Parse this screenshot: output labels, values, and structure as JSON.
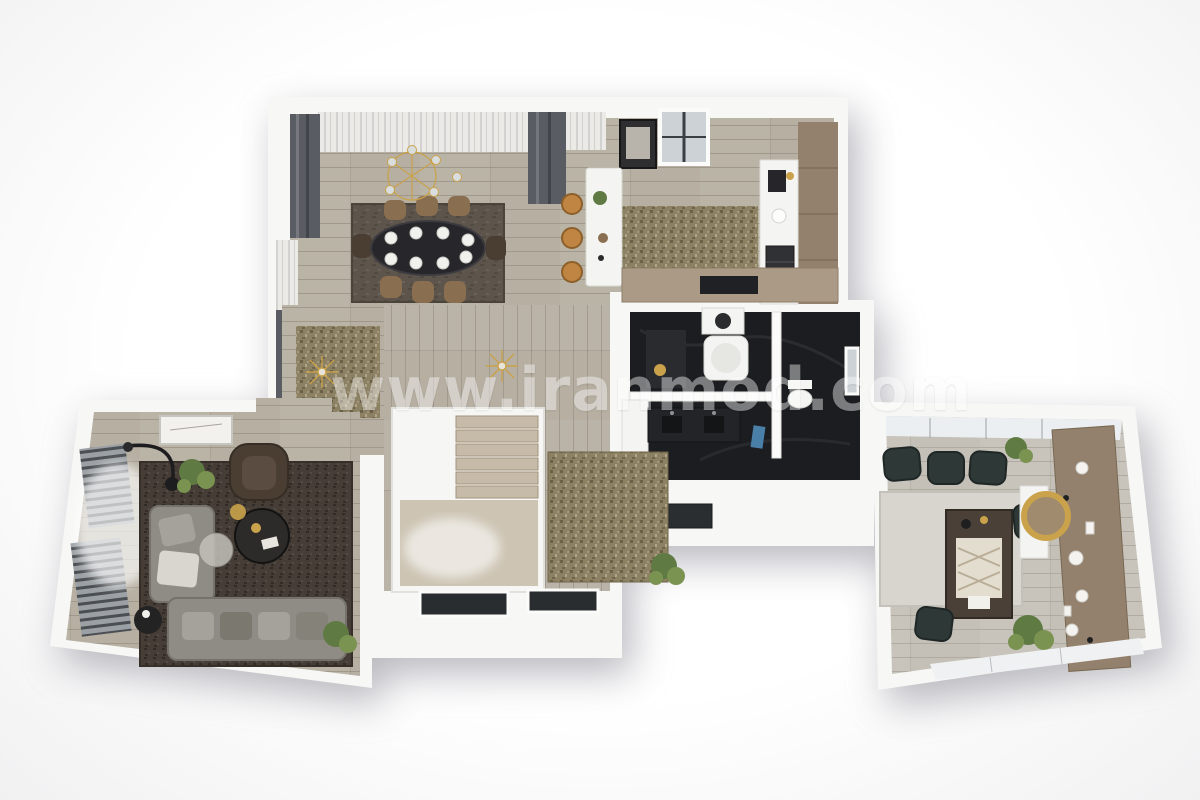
{
  "meta": {
    "description": "3D rendered top-down floor plan of an apartment, photoreal style, no text labels except watermark"
  },
  "watermark": {
    "text": "www.iranmod.com"
  },
  "palette": {
    "page_bg": "#fafafa",
    "wall_white": "#f7f7f5",
    "wall_shadow": "#dddcd8",
    "wood_floor": "#b6afa2",
    "wood_floor_right": "#c4c0b7",
    "stairs_wood": "#c6bba8",
    "landing_wood": "#cdc4b3",
    "marble_dark": "#1c1d20",
    "rug_dining": "#5d554b",
    "rug_gold": "#8d8164",
    "rug_dark": "#453d36",
    "rug_light": "#d8d5ce",
    "sofa_gray": "#8f8c85",
    "cushion_gray": "#a5a29b",
    "armchair_brown": "#4a3e33",
    "chair_tan": "#8a6e50",
    "stool_amber": "#c08543",
    "chair_teal": "#2e3937",
    "table_dark": "#27272b",
    "wood_cabinet": "#93816e",
    "peninsula_wood": "#ab9a86",
    "gold_accent": "#c9a24b",
    "plant_green": "#5f7a43",
    "plant_green_light": "#7a9350",
    "fixture_white": "#f4f4f2",
    "curtain_dark": "#595c62",
    "curtain_sheer": "#eceae7",
    "window_glass": "#ccd2d6",
    "towel_blue": "#4a7fa8",
    "watermark": "#ffffff"
  },
  "rooms": [
    {
      "id": "dining-living",
      "name": "Dining / living area",
      "furniture": [
        "oval dark dining table",
        "white dinner plates",
        "8 tan chairs",
        "gold wireframe chandelier",
        "dark taupe area rug",
        "dark gray drapes",
        "white sheer curtains",
        "wall art frame",
        "black-frame window",
        "gold textured entry rug",
        "sputnik pendant lights"
      ]
    },
    {
      "id": "kitchen",
      "name": "Kitchen",
      "furniture": [
        "white island bar",
        "3 amber bar stools",
        "olive textured rug",
        "wood wall cabinets",
        "white counter with coffee machine",
        "built-in oven",
        "wood peninsula counter with cooktop",
        "window"
      ]
    },
    {
      "id": "bathroom",
      "name": "Bathroom / laundry (dark marble)",
      "furniture": [
        "washing machine",
        "bathtub",
        "toilet",
        "dark double-sink vanity",
        "white vanity cabinets",
        "marble floor",
        "small window",
        "blue towel"
      ]
    },
    {
      "id": "hallway",
      "name": "Hallway and staircase",
      "furniture": [
        "white stair enclosure",
        "wood stair treads",
        "wood landing with daylight glow",
        "olive corridor rug",
        "green plants",
        "two dark floor windows in bottom wall"
      ]
    },
    {
      "id": "living-lounge",
      "name": "Living lounge (left wing)",
      "furniture": [
        "L-shaped gray sofa with cushions",
        "brown leather armchair",
        "round dark coffee table",
        "round glass side table",
        "black arc floor lamp",
        "dark brown area rug",
        "louvered window shutters",
        "daylight glow",
        "wall art frame",
        "plants",
        "black side table"
      ]
    },
    {
      "id": "family-room",
      "name": "Family / dining room (right wing)",
      "furniture": [
        "window wall",
        "3 dark teal armchairs",
        "light gray rug",
        "dark wood table with patterned cream runner",
        "teal side chairs",
        "wood shelving sideboard with white plates",
        "white console",
        "round gold-framed mirror",
        "plants",
        "bottom window band"
      ]
    }
  ]
}
